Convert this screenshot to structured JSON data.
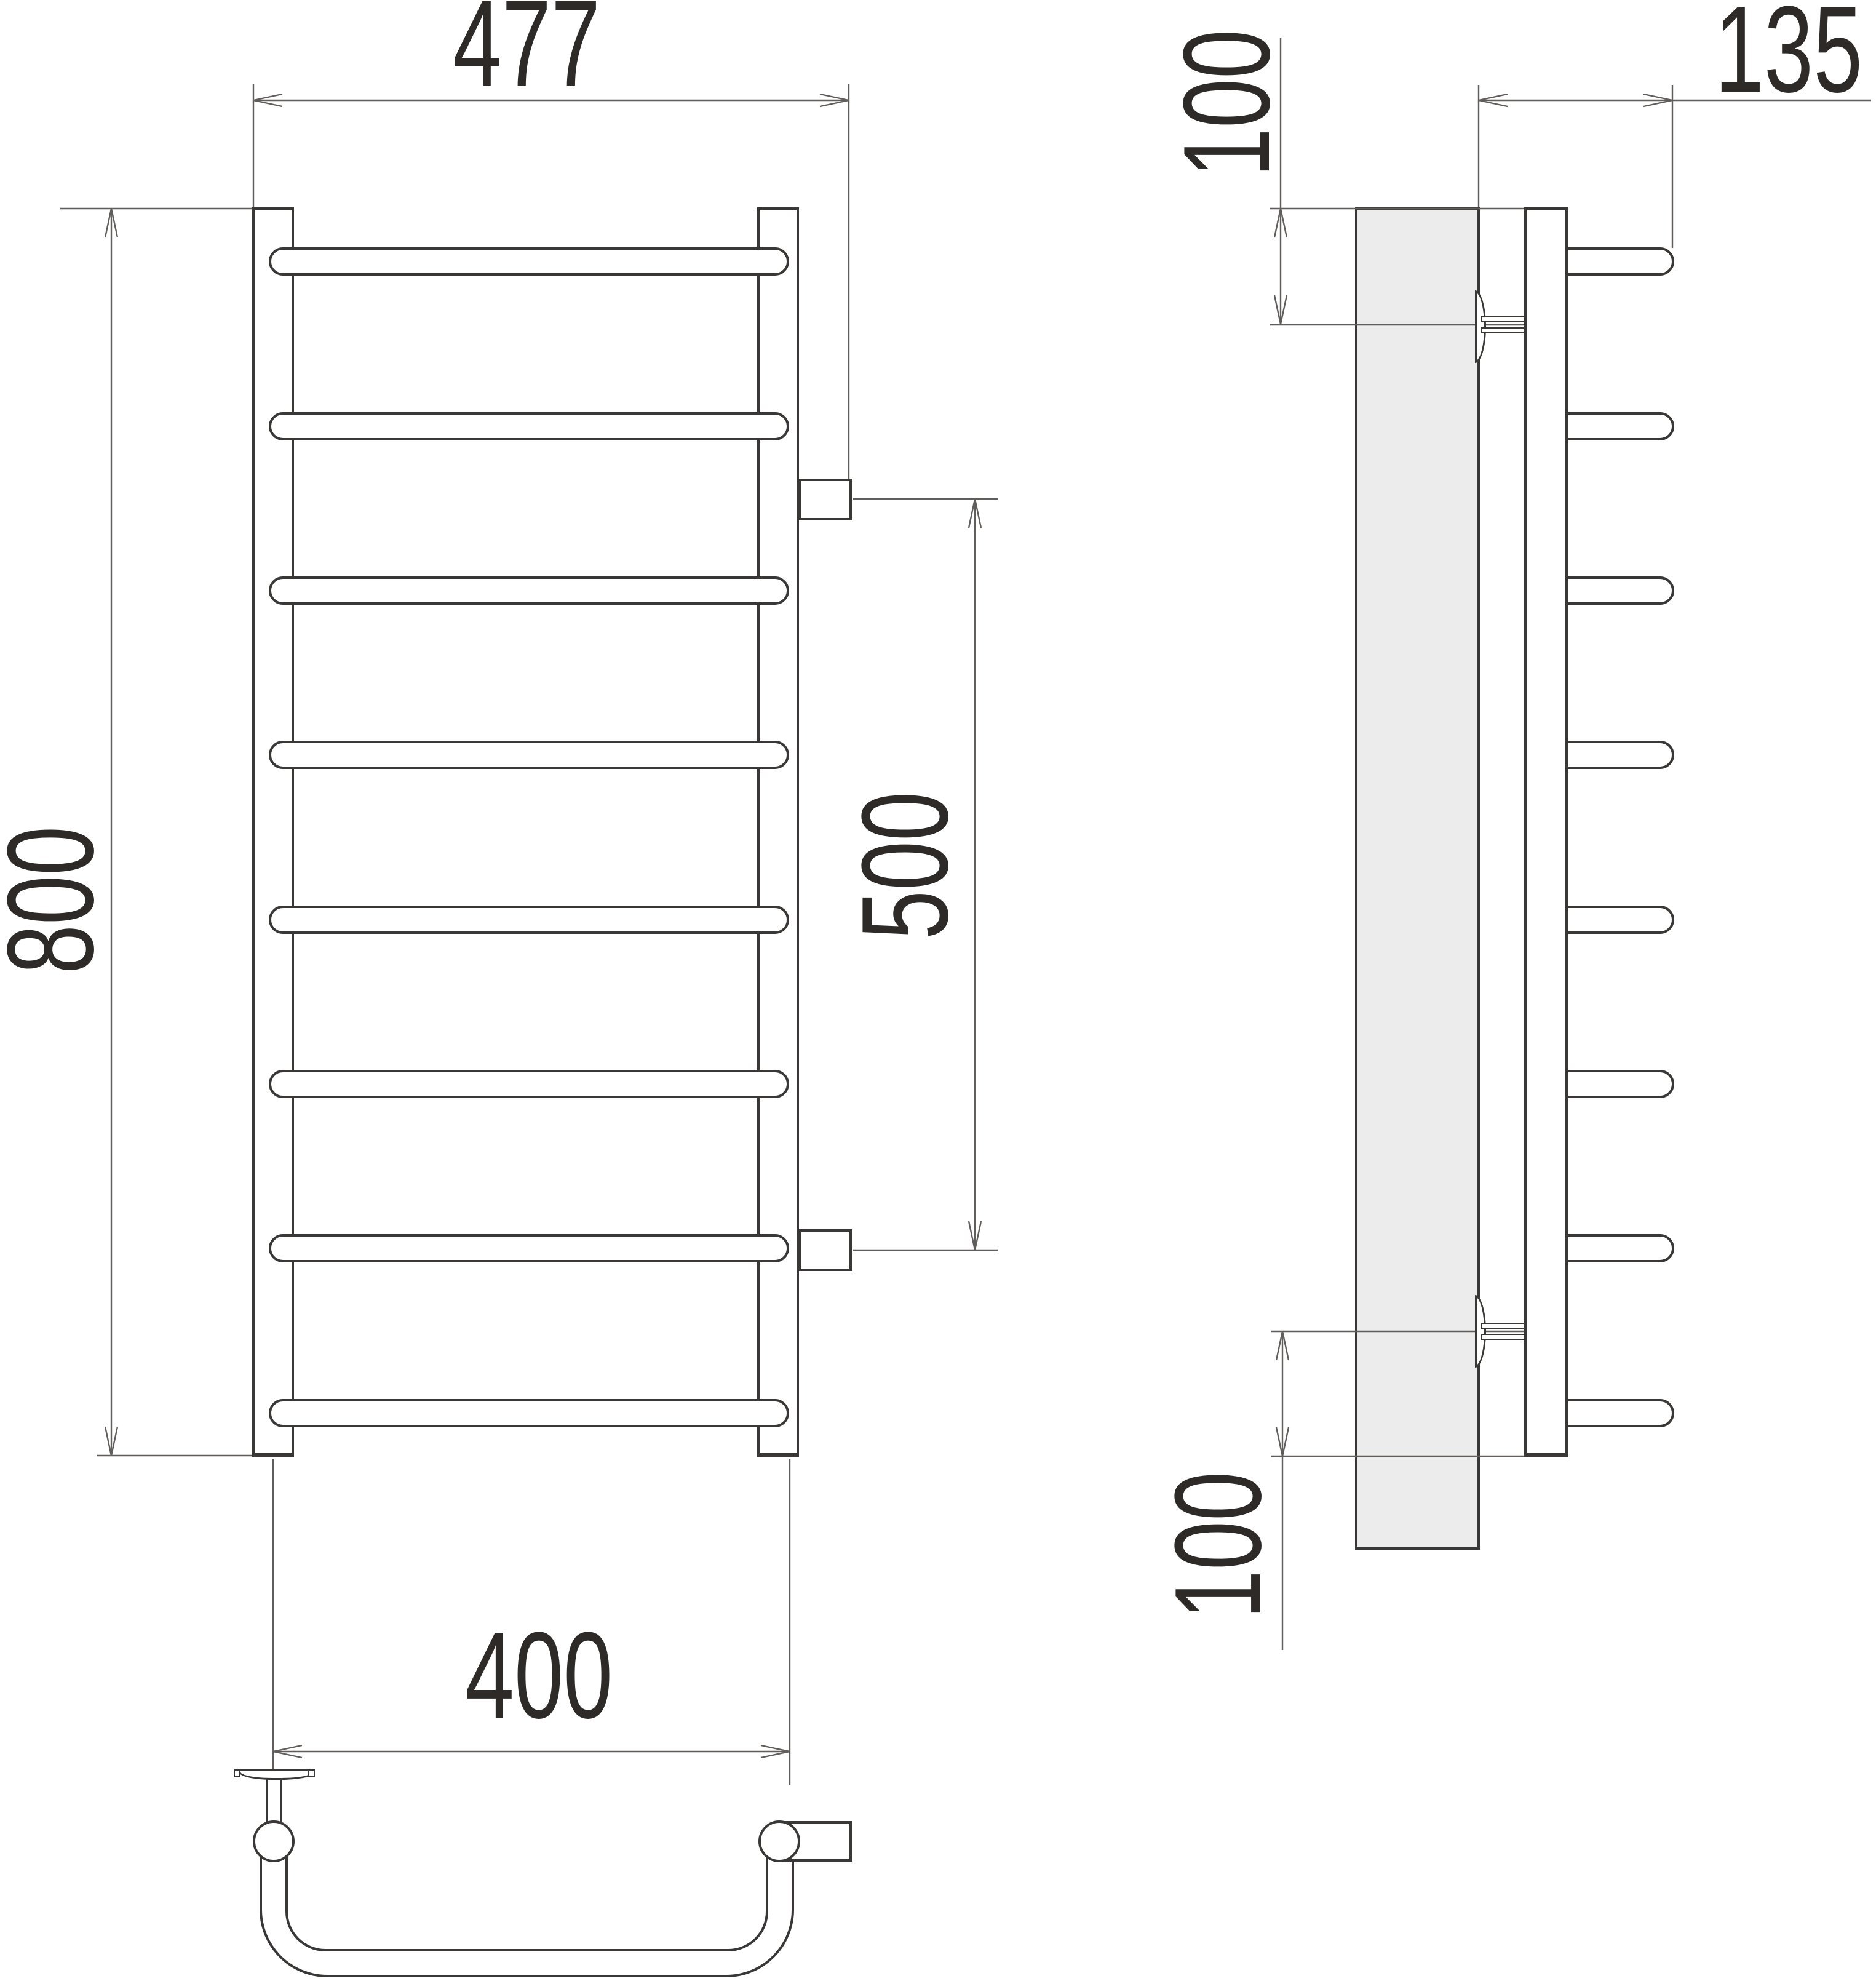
{
  "drawing": {
    "labels": {
      "front_width": "477",
      "front_height": "800",
      "rail_spacing": "400",
      "connection_spacing": "500",
      "side_top_offset": "100",
      "side_bottom_offset": "100",
      "side_depth": "135"
    },
    "rung_count": 8,
    "colors": {
      "line": "#3a3836",
      "thin-line": "#605d5b",
      "text": "#2d2a28",
      "wall-fill": "#ececec",
      "background": "#ffffff"
    }
  }
}
